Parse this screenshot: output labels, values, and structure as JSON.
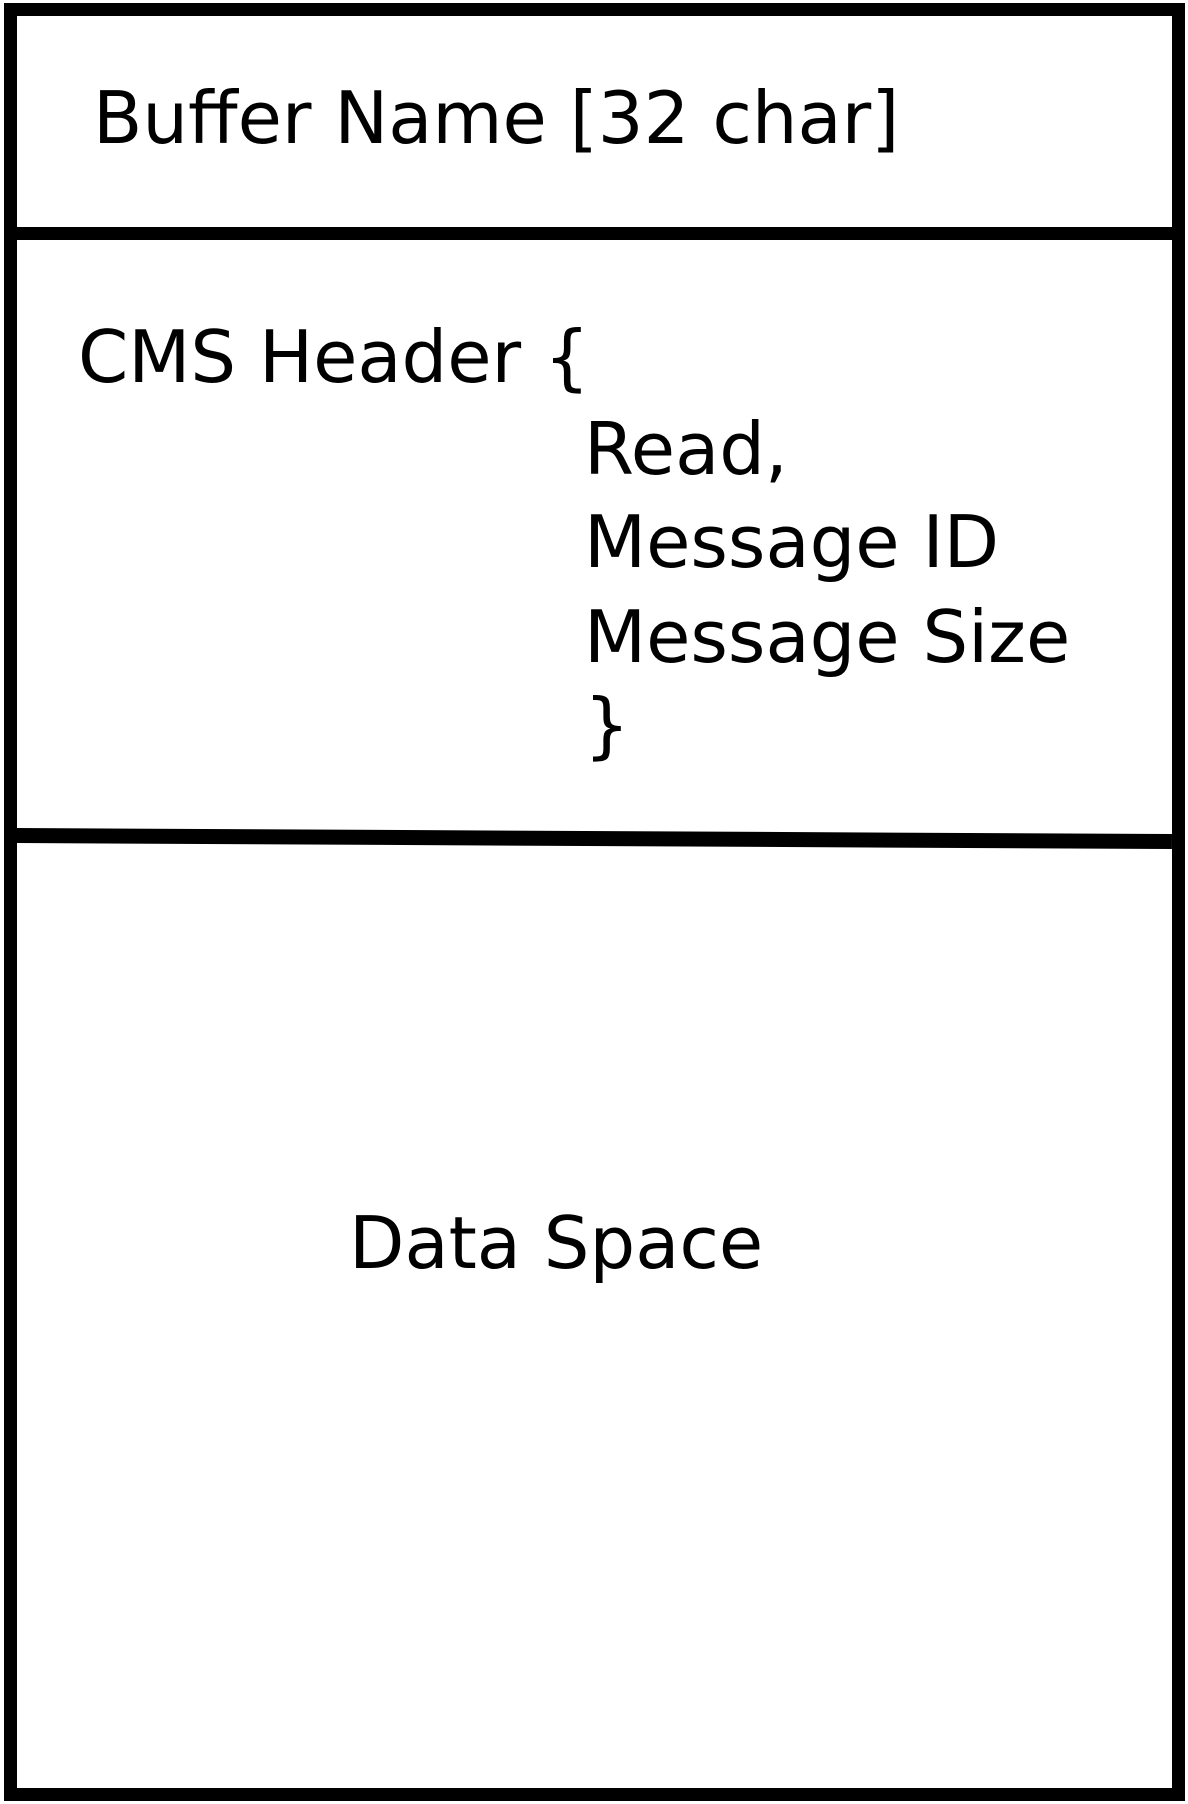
{
  "diagram": {
    "buffer_name": "Buffer Name [32 char]",
    "cms_header": {
      "open": "CMS Header {",
      "fields": [
        "Read,",
        "Message ID",
        "Message Size"
      ],
      "close": "}"
    },
    "data_space": "Data Space",
    "colors": {
      "line": "#000000",
      "background": "#ffffff",
      "text": "#000000"
    }
  }
}
